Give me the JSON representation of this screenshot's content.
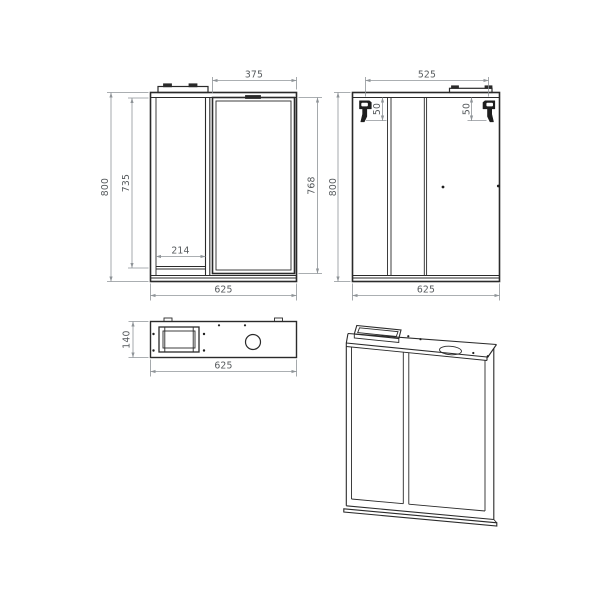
{
  "drawing": {
    "type": "technical-drawing",
    "subject": "mirror-cabinet",
    "units": "mm",
    "colors": {
      "background": "#ffffff",
      "object_line": "#2a2a2a",
      "dimension_line": "#8f9498",
      "dimension_text": "#55595c"
    },
    "views": {
      "front": {
        "name": "front-view",
        "dims": {
          "door_width": "375",
          "overall_height": "800",
          "cabinet_inner_height": "735",
          "door_height": "768",
          "shelf_width": "214",
          "overall_width": "625"
        }
      },
      "back": {
        "name": "back-view",
        "dims": {
          "hanger_spacing": "525",
          "hanger_drop_left": "50",
          "hanger_drop_right": "50",
          "overall_height": "800",
          "overall_width": "625"
        }
      },
      "top": {
        "name": "top-view",
        "dims": {
          "depth": "140",
          "overall_width": "625"
        }
      },
      "perspective": {
        "name": "perspective-view"
      }
    }
  }
}
